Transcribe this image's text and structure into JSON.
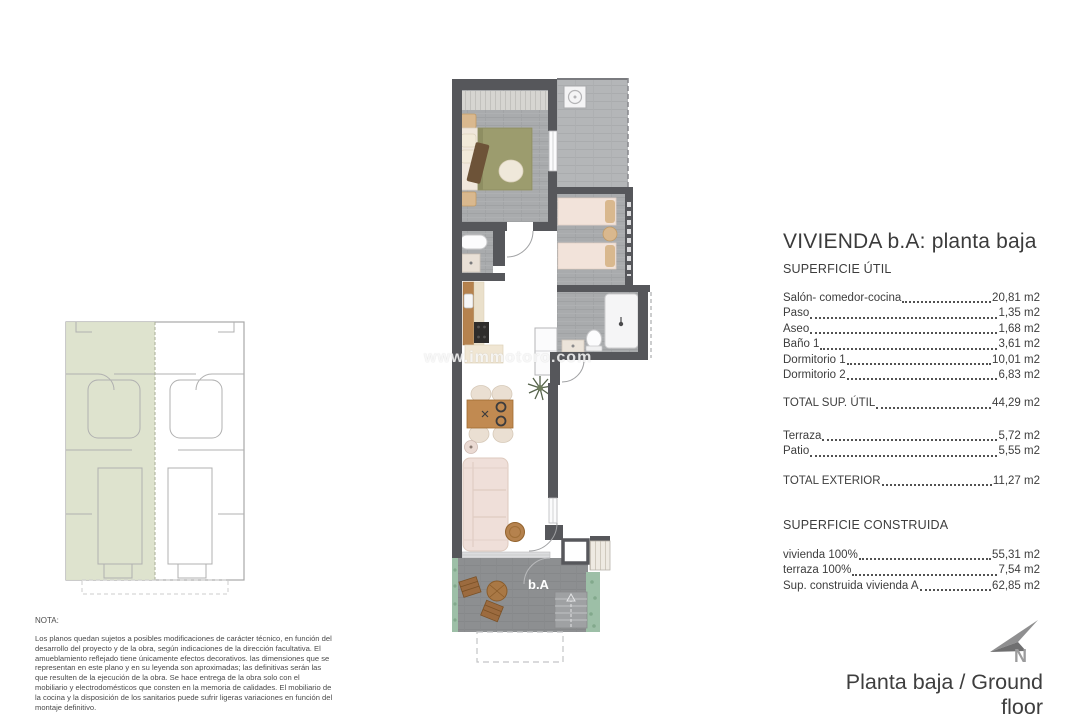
{
  "title": "VIVIENDA b.A: planta baja",
  "superficie_util": {
    "heading": "SUPERFICIE ÚTIL",
    "rows": [
      {
        "label": "Salón- comedor-cocina",
        "value": "20,81 m2"
      },
      {
        "label": "Paso",
        "value": "1,35 m2"
      },
      {
        "label": "Aseo",
        "value": "1,68 m2"
      },
      {
        "label": "Baño 1",
        "value": "3,61 m2"
      },
      {
        "label": "Dormitorio 1",
        "value": "10,01 m2"
      },
      {
        "label": "Dormitorio 2",
        "value": "6,83 m2"
      }
    ],
    "total": {
      "label": "TOTAL SUP. ÚTIL",
      "value": "44,29 m2"
    },
    "exterior": [
      {
        "label": "Terraza",
        "value": "5,72 m2"
      },
      {
        "label": "Patio",
        "value": "5,55 m2"
      }
    ],
    "exterior_total": {
      "label": "TOTAL EXTERIOR",
      "value": "11,27 m2"
    }
  },
  "superficie_construida": {
    "heading": "SUPERFICIE CONSTRUIDA",
    "rows": [
      {
        "label": "vivienda 100%",
        "value": "55,31 m2"
      },
      {
        "label": "terraza 100%",
        "value": "7,54 m2"
      },
      {
        "label": "Sup. construida vivienda A",
        "value": "62,85 m2"
      }
    ]
  },
  "nota": {
    "label": "NOTA:",
    "body": "Los planos quedan sujetos a posibles modificaciones de carácter técnico, en función del desarrollo del proyecto y de la obra, según indicaciones de la dirección facultativa. El amueblamiento reflejado tiene únicamente efectos decorativos. las dimensiones que se representan en este plano y en su leyenda son aproximadas; las definitivas serán las que resulten de la ejecución de la obra. Se hace entrega de la obra solo con el mobiliario y electrodomésticos que consten en la memoria de calidades. El mobiliario de la cocina y la disposición de los sanitarios puede sufrir ligeras variaciones en función del montaje definitivo."
  },
  "plan": {
    "unit_label": "b.A"
  },
  "watermark": "www.immotoro.com",
  "compass": {
    "label": "N"
  },
  "footer": {
    "caption": "Planta baja / Ground floor"
  },
  "colors": {
    "wall": "#56575b",
    "floor_wood": "#a9abad",
    "patio_floor": "#b4b6b8",
    "terrace_floor": "#8d8f91",
    "key_plan_highlight": "#dce2cb",
    "landscape_green": "#9dbfa7",
    "wood_furniture": "#b5824e",
    "bed_olive": "#9c9c6e",
    "upholstery_pink": "#efdfd9",
    "text": "#3d3d3d"
  }
}
